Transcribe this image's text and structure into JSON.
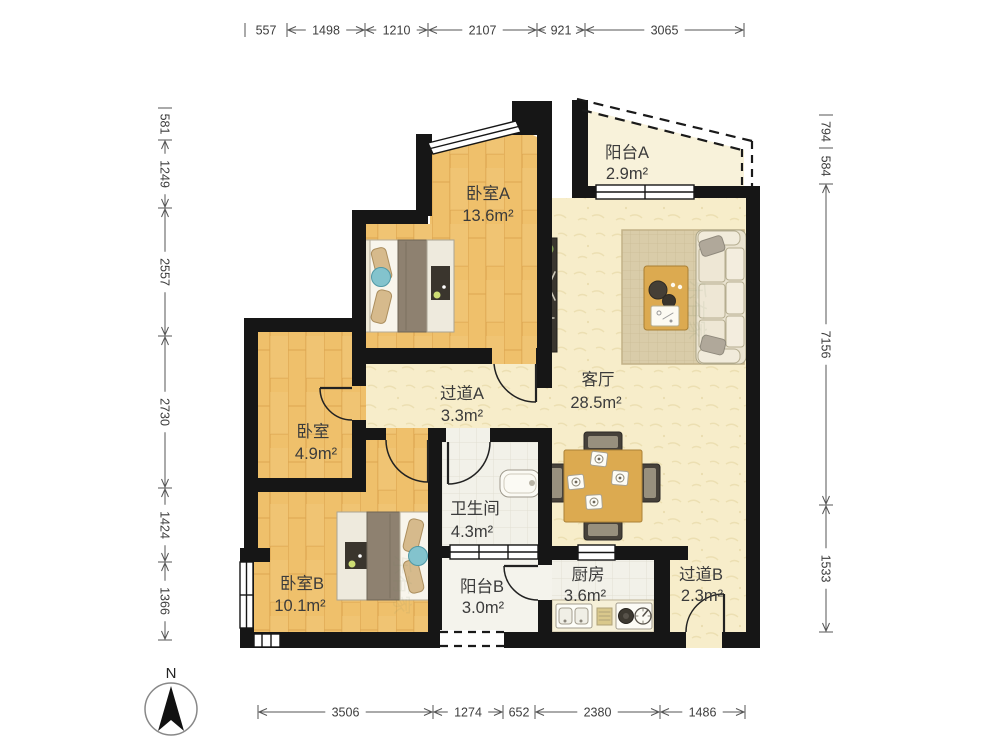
{
  "floor_plan": {
    "compass_label": "N",
    "watermark_text": "乐有家",
    "rooms": [
      {
        "id": "bedroom-a",
        "name": "卧室A",
        "area": "13.6m²"
      },
      {
        "id": "balcony-a",
        "name": "阳台A",
        "area": "2.9m²"
      },
      {
        "id": "living-room",
        "name": "客厅",
        "area": "28.5m²"
      },
      {
        "id": "hallway-a",
        "name": "过道A",
        "area": "3.3m²"
      },
      {
        "id": "bedroom",
        "name": "卧室",
        "area": "4.9m²"
      },
      {
        "id": "bathroom",
        "name": "卫生间",
        "area": "4.3m²"
      },
      {
        "id": "bedroom-b",
        "name": "卧室B",
        "area": "10.1m²"
      },
      {
        "id": "balcony-b",
        "name": "阳台B",
        "area": "3.0m²"
      },
      {
        "id": "kitchen",
        "name": "厨房",
        "area": "3.6m²"
      },
      {
        "id": "hallway-b",
        "name": "过道B",
        "area": "2.3m²"
      }
    ],
    "dimensions_mm": {
      "top": [
        "557",
        "1498",
        "1210",
        "2107",
        "921",
        "3065"
      ],
      "left": [
        "581",
        "1249",
        "2557",
        "2730",
        "1424",
        "1366"
      ],
      "right": [
        "794",
        "584",
        "7156",
        "1533"
      ],
      "bottom": [
        "3506",
        "1274",
        "652",
        "2380",
        "1486"
      ]
    }
  }
}
